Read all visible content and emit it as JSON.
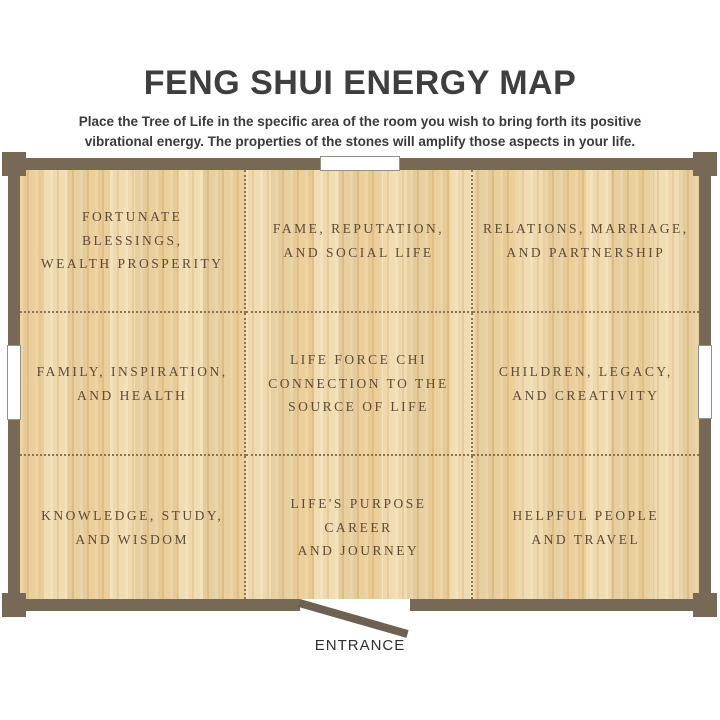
{
  "page": {
    "title": "FENG SHUI ENERGY MAP",
    "subtitle": "Place the Tree of Life in the specific area of the room you wish to bring forth its positive vibrational energy. The properties of the stones will amplify those aspects in your life."
  },
  "map": {
    "cells": [
      {
        "label": "FORTUNATE BLESSINGS,\nWEALTH PROSPERITY"
      },
      {
        "label": "FAME, REPUTATION,\nAND SOCIAL LIFE"
      },
      {
        "label": "RELATIONS, MARRIAGE,\nAND PARTNERSHIP"
      },
      {
        "label": "FAMILY, INSPIRATION,\nAND HEALTH"
      },
      {
        "label": "LIFE FORCE CHI\nCONNECTION TO THE\nSOURCE OF LIFE"
      },
      {
        "label": "CHILDREN, LEGACY,\nAND CREATIVITY"
      },
      {
        "label": "KNOWLEDGE, STUDY,\nAND WISDOM"
      },
      {
        "label": "LIFE'S PURPOSE CAREER\nAND JOURNEY"
      },
      {
        "label": "HELPFUL PEOPLE\nAND TRAVEL"
      }
    ],
    "entrance_label": "ENTRANCE"
  },
  "colors": {
    "wall": "#786856",
    "floor_base": "#ecd2a0",
    "cell_text": "#5e4a36",
    "grid_dots": "#8d7352",
    "heading_text": "#3e3e3e",
    "door": "#6f6152"
  }
}
